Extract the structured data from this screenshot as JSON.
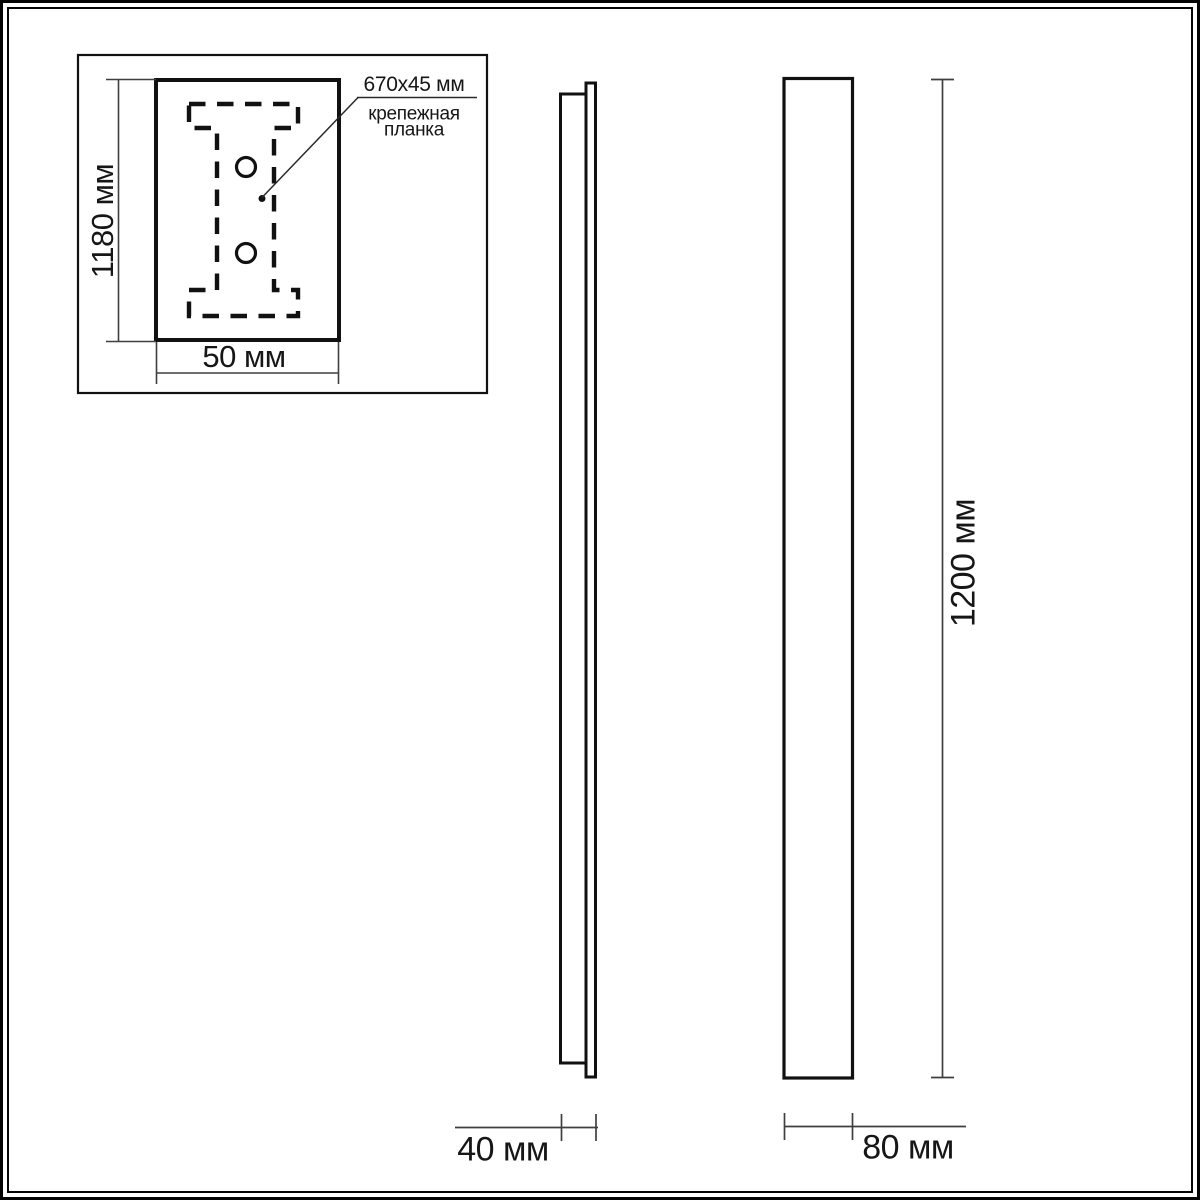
{
  "drawing": {
    "inset": {
      "height_label": "1180 мм",
      "width_label": "50 мм",
      "callout": {
        "size": "670x45 мм",
        "name": "крепежная планка"
      }
    },
    "side_view": {
      "depth_label": "40 мм"
    },
    "front_view": {
      "width_label": "80 мм",
      "height_label": "1200 мм"
    }
  },
  "colors": {
    "background": "#ffffff",
    "outline": "#111111",
    "dimension_line": "#3f3f3f",
    "text": "#161616",
    "page_border": "#050505"
  }
}
